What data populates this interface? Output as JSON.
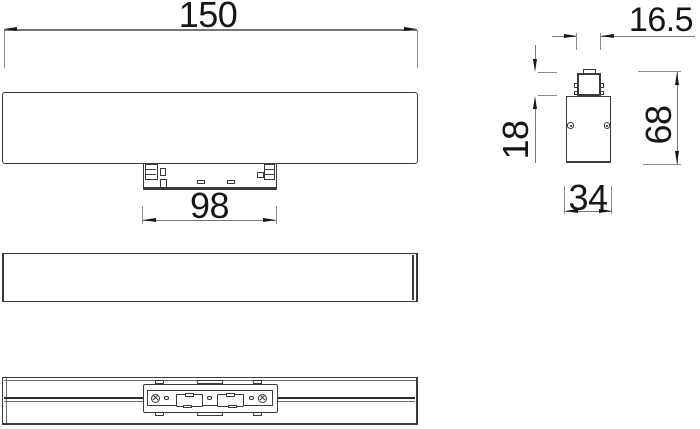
{
  "drawing": {
    "dims": {
      "front_width": "150",
      "bracket_width": "98",
      "connector_width": "16.5",
      "connector_height": "18",
      "side_height": "68",
      "side_width": "34"
    },
    "colors": {
      "outline": "#3a3a3a",
      "dim_line": "#757575",
      "arrow_and_text": "#151515",
      "background": "#ffffff"
    }
  }
}
